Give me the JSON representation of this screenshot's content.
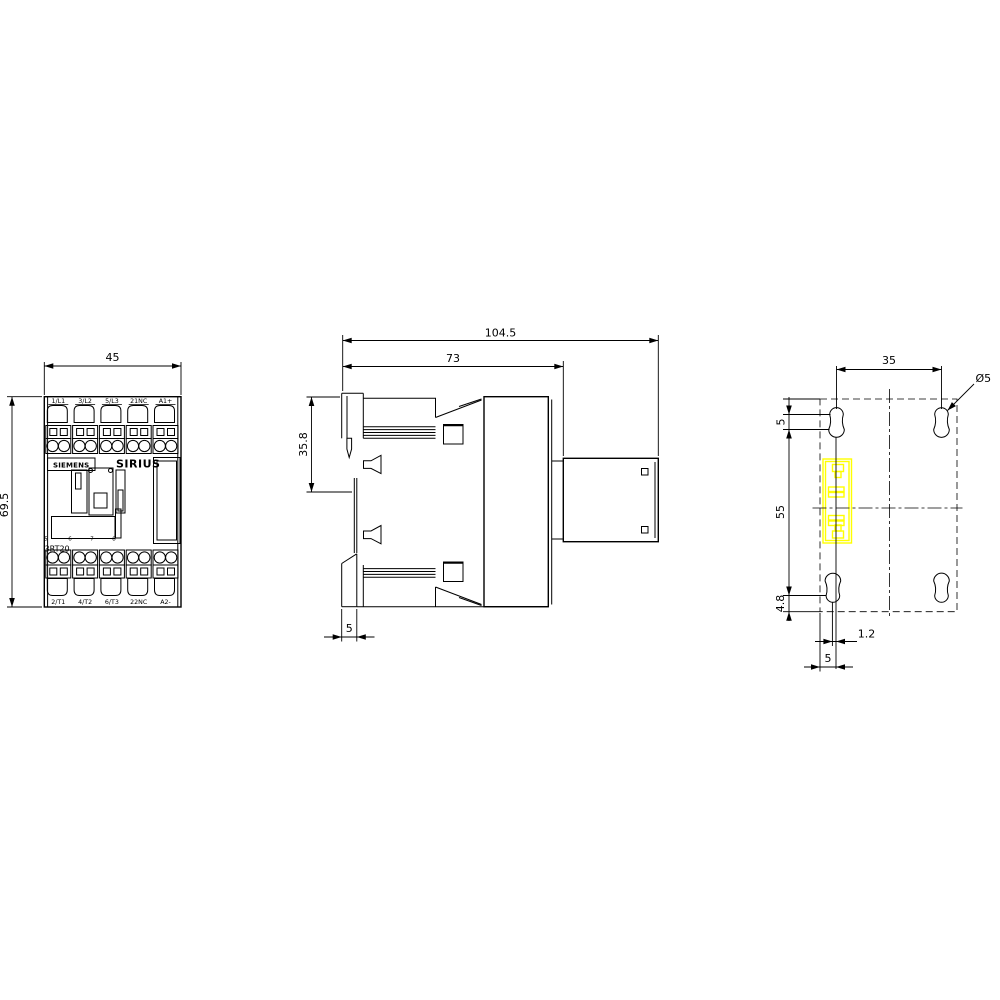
{
  "colors": {
    "line": "#000000",
    "background": "#ffffff",
    "highlight": "#ffff00"
  },
  "front_view": {
    "dim_width": "45",
    "dim_height": "69.5",
    "top_terminals": [
      "1/L1",
      "3/L2",
      "5/L3",
      "21NC",
      "A1+"
    ],
    "bottom_terminals": [
      "2/T1",
      "4/T2",
      "6/T3",
      "22NC",
      "A2-"
    ],
    "brand": "SIEMENS",
    "series": "SIRIUS",
    "model": "3RT20",
    "scale_marks": [
      "5",
      "6",
      "7",
      "8"
    ]
  },
  "side_view": {
    "dim_total_depth": "104.5",
    "dim_body_depth": "73",
    "dim_upper_height": "35.8",
    "dim_foot_width": "5"
  },
  "drill_plan": {
    "dim_hole_spacing": "35",
    "dim_hole_diameter": "Ø5",
    "dim_slot_pitch": "5",
    "dim_vertical_spacing": "55",
    "dim_bottom_offset": "4.8",
    "dim_hole_misalignment": "1.2",
    "dim_edge_offset": "5"
  }
}
